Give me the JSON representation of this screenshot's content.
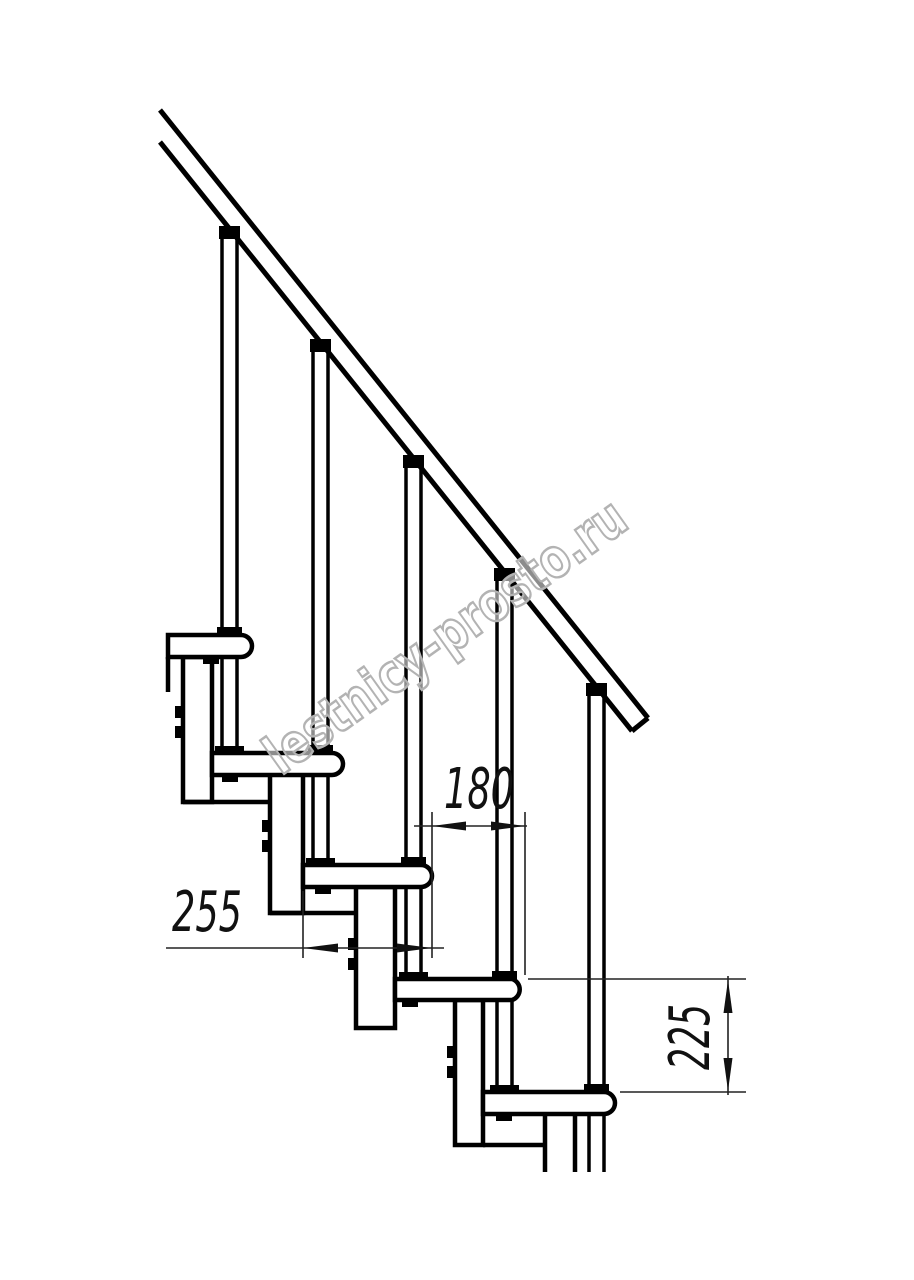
{
  "page": {
    "background": "#ffffff"
  },
  "drawing": {
    "type": "technical-line-drawing",
    "subject": "modular-staircase-side-elevation",
    "steps_visible": 5,
    "colors": {
      "main_line": "#000000",
      "dimension_line": "#222222",
      "watermark": "#b3b3b3"
    },
    "dimensions": {
      "tread_depth_mm": "255",
      "step_run_mm": "180",
      "step_rise_mm": "225"
    },
    "watermark": "lestnicy-prosto.ru"
  }
}
